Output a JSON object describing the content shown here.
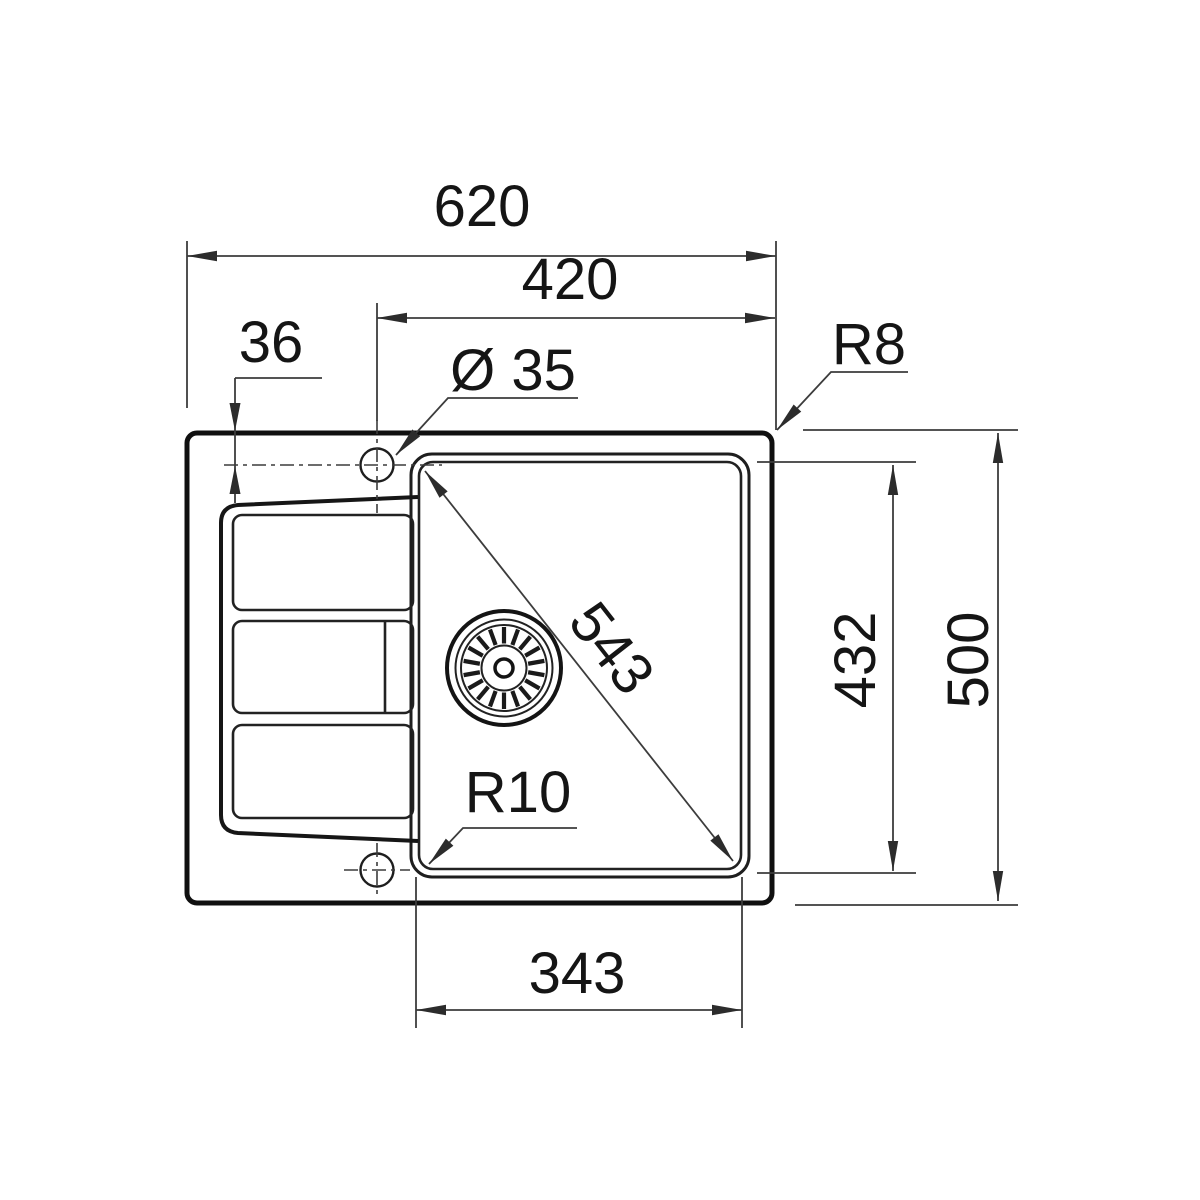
{
  "drawing": {
    "type": "technical-dimension-drawing",
    "subject": "inset kitchen sink with single bowl and drainer, top view",
    "labels": {
      "overall_width": "620",
      "width_tap_center_to_right_edge": "420",
      "tap_center_offset_from_edge": "36",
      "tap_hole_diameter": "Ø 35",
      "outer_corner_radius": "R8",
      "bowl_diagonal": "543",
      "bowl_inner_depth": "432",
      "overall_depth": "500",
      "bowl_corner_radius": "R10",
      "bowl_inner_width": "343"
    },
    "colors": {
      "background": "#ffffff",
      "outline": "#101010",
      "medium_line": "#1e1e1e",
      "dimension_line": "#3c3c3c",
      "text": "#151515"
    }
  }
}
